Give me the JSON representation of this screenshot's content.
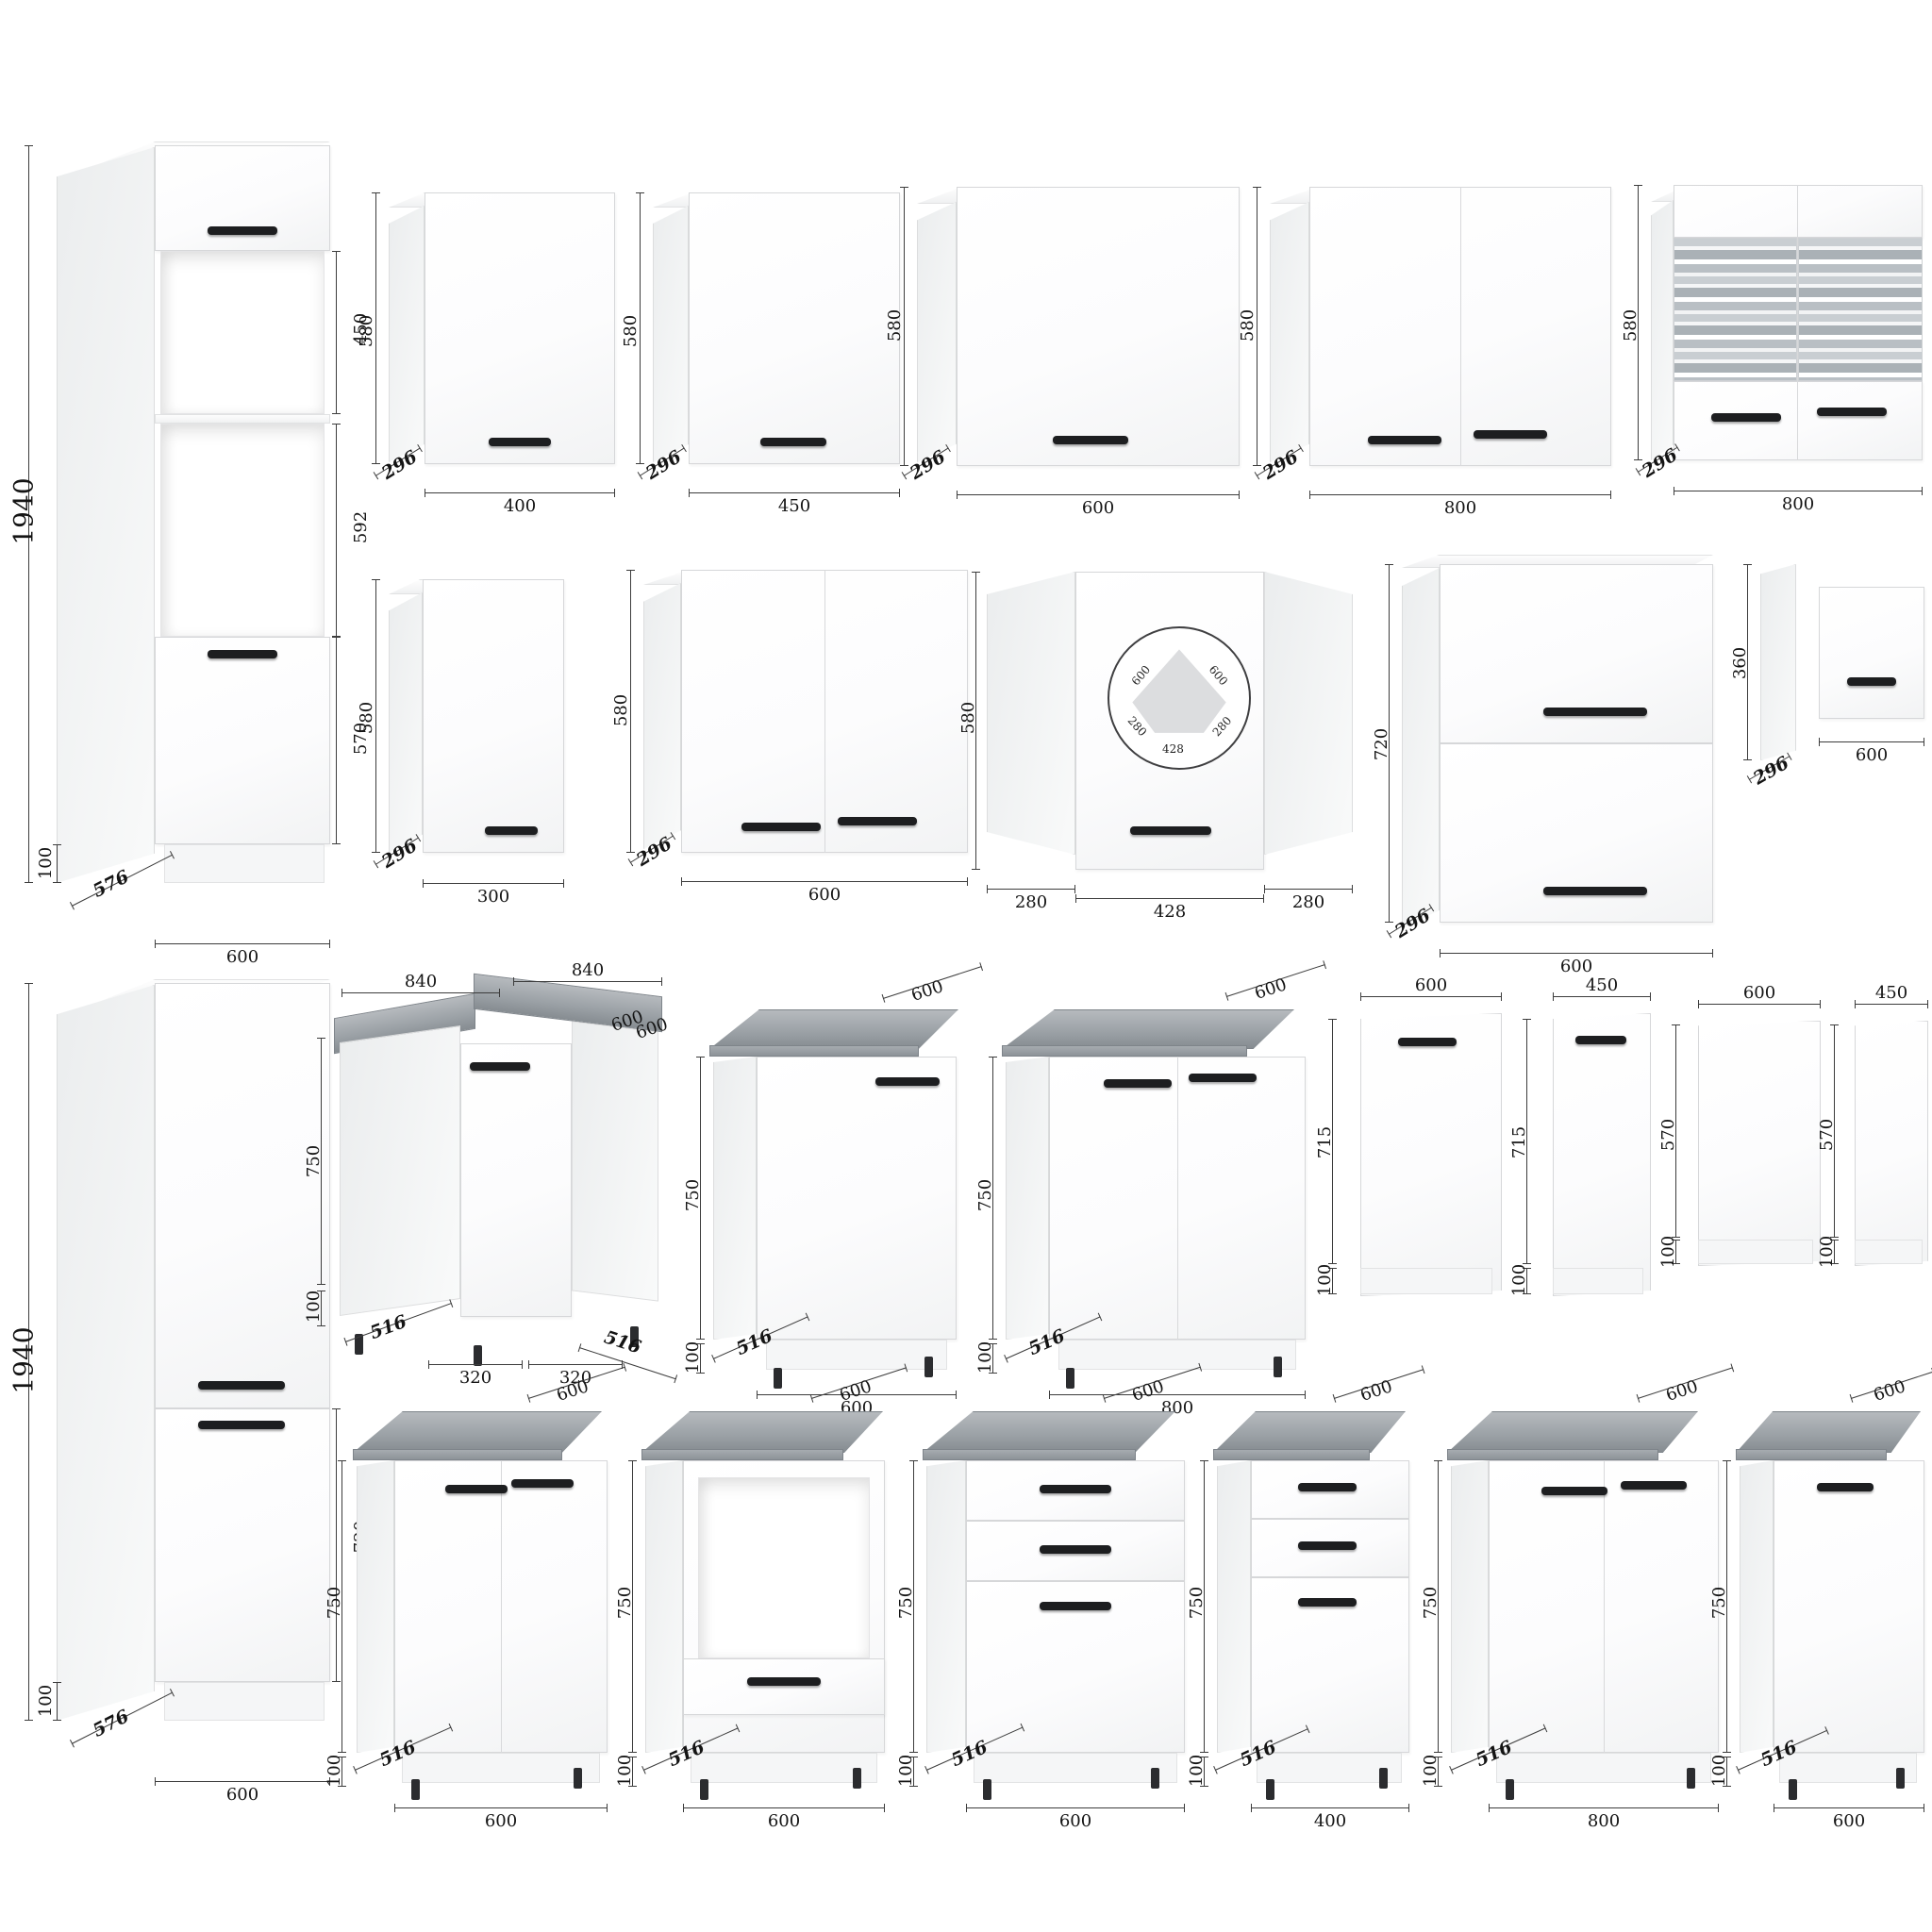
{
  "c": {
    "t1": {
      "h": "1940",
      "p": "100",
      "dep": "576",
      "w": "600",
      "s1": "450",
      "s2": "592",
      "s3": "570"
    },
    "w400": {
      "h": "580",
      "d": "296",
      "w": "400"
    },
    "w450": {
      "h": "580",
      "d": "296",
      "w": "450"
    },
    "w600": {
      "h": "580",
      "d": "296",
      "w": "600"
    },
    "w800": {
      "h": "580",
      "d": "296",
      "w": "800"
    },
    "w800g": {
      "h": "580",
      "d": "296",
      "w": "800"
    },
    "w300": {
      "h": "580",
      "d": "296",
      "w": "300"
    },
    "w600b": {
      "h": "580",
      "d": "296",
      "w": "600"
    },
    "wc": {
      "h": "580",
      "l": "280",
      "m": "428",
      "r": "280",
      "p1": "600",
      "p2": "600",
      "p3": "280",
      "p4": "280",
      "p5": "428"
    },
    "w720": {
      "h": "720",
      "d": "296",
      "w": "600"
    },
    "w360": {
      "h": "360",
      "d": "296",
      "w": "600"
    },
    "t2": {
      "h": "1940",
      "p": "100",
      "dep": "576",
      "w": "600",
      "s1": "720"
    },
    "bc": {
      "t1": "840",
      "t2": "840",
      "r1": "600",
      "r2": "600",
      "h": "750",
      "p": "100",
      "b1": "516",
      "b2": "320",
      "b3": "320",
      "b4": "516"
    },
    "b1": {
      "t": "600",
      "h": "750",
      "p": "100",
      "d": "516",
      "w": "600"
    },
    "b2": {
      "t": "600",
      "h": "750",
      "p": "100",
      "d": "516",
      "w": "800"
    },
    "p1": {
      "t": "600",
      "h": "715",
      "p": "100"
    },
    "p2": {
      "t": "450",
      "h": "715",
      "p": "100"
    },
    "p3": {
      "t": "600",
      "h": "570",
      "p": "100"
    },
    "p4": {
      "t": "450",
      "h": "570",
      "p": "100"
    },
    "b3": {
      "t": "600",
      "h": "750",
      "p": "100",
      "d": "516",
      "w": "600"
    },
    "b4": {
      "t": "600",
      "h": "750",
      "p": "100",
      "d": "516",
      "w": "600"
    },
    "b5": {
      "t": "600",
      "h": "750",
      "p": "100",
      "d": "516",
      "w": "600"
    },
    "b6": {
      "t": "600",
      "h": "750",
      "p": "100",
      "d": "516",
      "w": "400"
    },
    "b7": {
      "t": "600",
      "h": "750",
      "p": "100",
      "d": "516",
      "w": "800"
    },
    "b8": {
      "t": "600",
      "h": "750",
      "p": "100",
      "d": "516",
      "w": "600"
    }
  }
}
